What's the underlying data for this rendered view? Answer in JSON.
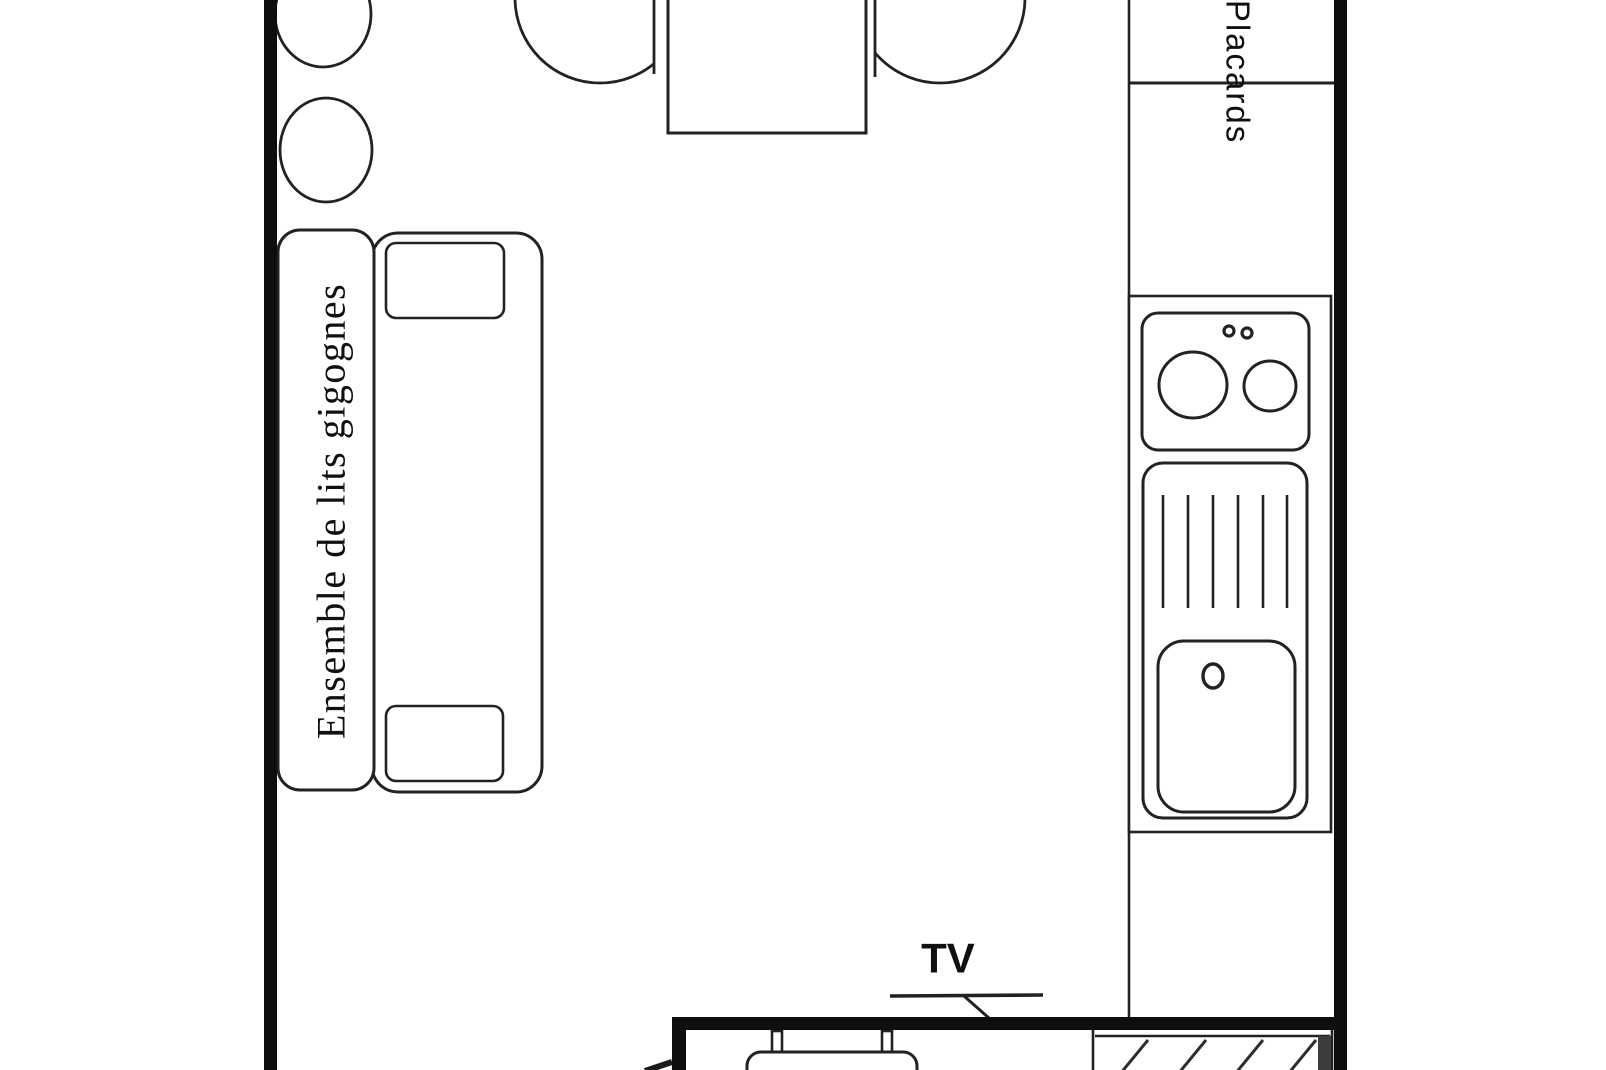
{
  "meta": {
    "type": "floor-plan",
    "language": "fr"
  },
  "canvas": {
    "width": 1606,
    "height": 1070,
    "background": "#ffffff"
  },
  "colors": {
    "wall": "#0e0e0e",
    "line": "#222222",
    "line_soft": "#2e2e2e",
    "hatch_bar": "#3c3c3c",
    "text": "#101010",
    "fill": "#ffffff"
  },
  "labels": {
    "bed": "Ensemble de lits gigognes",
    "closets": "Placards",
    "tv": "TV"
  },
  "legend": [
    "stool-circle-top",
    "stool-circle-bottom",
    "dining-table",
    "chair-left",
    "chair-right",
    "trundle-bed-block",
    "bed-label-box",
    "pillow-top",
    "pillow-bottom",
    "closets-column",
    "kitchen-counter",
    "stove-two-burners",
    "stove-knobs",
    "drainer-ribs",
    "sink-basin",
    "sink-drain",
    "tv-shelf",
    "bench-seat",
    "hatched-cabinet",
    "walls"
  ]
}
